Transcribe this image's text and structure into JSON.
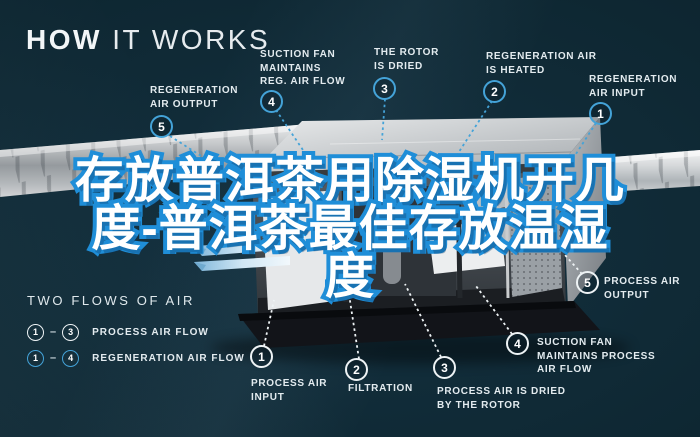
{
  "colors": {
    "background": "#0d2531",
    "accent_blue": "#44a3d8",
    "title_outline_blue": "#1f8ed8",
    "label_text": "#e3ebef",
    "process_white": "#eef3f5"
  },
  "header": {
    "bold": "HOW",
    "light": "IT WORKS"
  },
  "overlay_title": {
    "full": "存放普洱茶用除湿机开几度-普洱茶最佳存放温湿度",
    "line1": "存放普洱茶用除湿机开几",
    "line2": "度-普洱茶最佳存放温湿",
    "line3": "度"
  },
  "regeneration_steps": [
    {
      "num": "1",
      "label": "REGENERATION\nAIR INPUT"
    },
    {
      "num": "2",
      "label": "REGENERATION AIR\nIS HEATED"
    },
    {
      "num": "3",
      "label": "THE ROTOR\nIS DRIED"
    },
    {
      "num": "4",
      "label": "SUCTION FAN\nMAINTAINS\nREG. AIR FLOW"
    },
    {
      "num": "5",
      "label": "REGENERATION\nAIR OUTPUT"
    }
  ],
  "process_steps": [
    {
      "num": "1",
      "label": "PROCESS AIR\nINPUT"
    },
    {
      "num": "2",
      "label": "FILTRATION"
    },
    {
      "num": "3",
      "label": "PROCESS AIR IS DRIED\nBY THE ROTOR"
    },
    {
      "num": "4",
      "label": "SUCTION FAN\nMAINTAINS PROCESS\nAIR FLOW"
    },
    {
      "num": "5",
      "label": "PROCESS AIR\nOUTPUT"
    }
  ],
  "legend": {
    "title": "TWO FLOWS OF AIR",
    "rows": [
      {
        "from": "1",
        "to": "3",
        "dash": "–",
        "label": "PROCESS AIR FLOW"
      },
      {
        "from": "1",
        "to": "4",
        "dash": "–",
        "label": "REGENERATION AIR FLOW"
      }
    ]
  }
}
